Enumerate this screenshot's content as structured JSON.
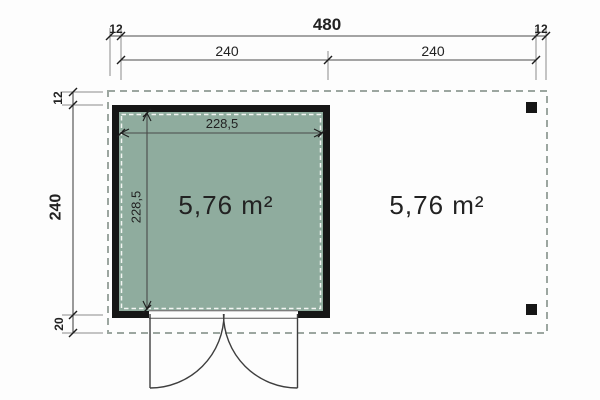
{
  "drawing": {
    "type": "floor-plan",
    "areas": {
      "room_area": "5,76 m²",
      "terrace_area": "5,76 m²"
    },
    "dims": {
      "top_overhang_left": "12",
      "top_total": "480",
      "top_overhang_right": "12",
      "top_bay_left": "240",
      "top_bay_right": "240",
      "left_overhang_top": "12",
      "left_total": "240",
      "left_overhang_bottom": "20",
      "room_inner_width": "228,5",
      "room_inner_depth": "228,5"
    }
  },
  "colors": {
    "background": "#fdfdfd",
    "room_fill": "#8fac9e",
    "wall": "#161616",
    "roof_outline": "#9ca6a0",
    "inner_dash": "#f2f5f2",
    "area_text_light": "#eff3f0",
    "area_text_dark": "#2e2e2e"
  }
}
